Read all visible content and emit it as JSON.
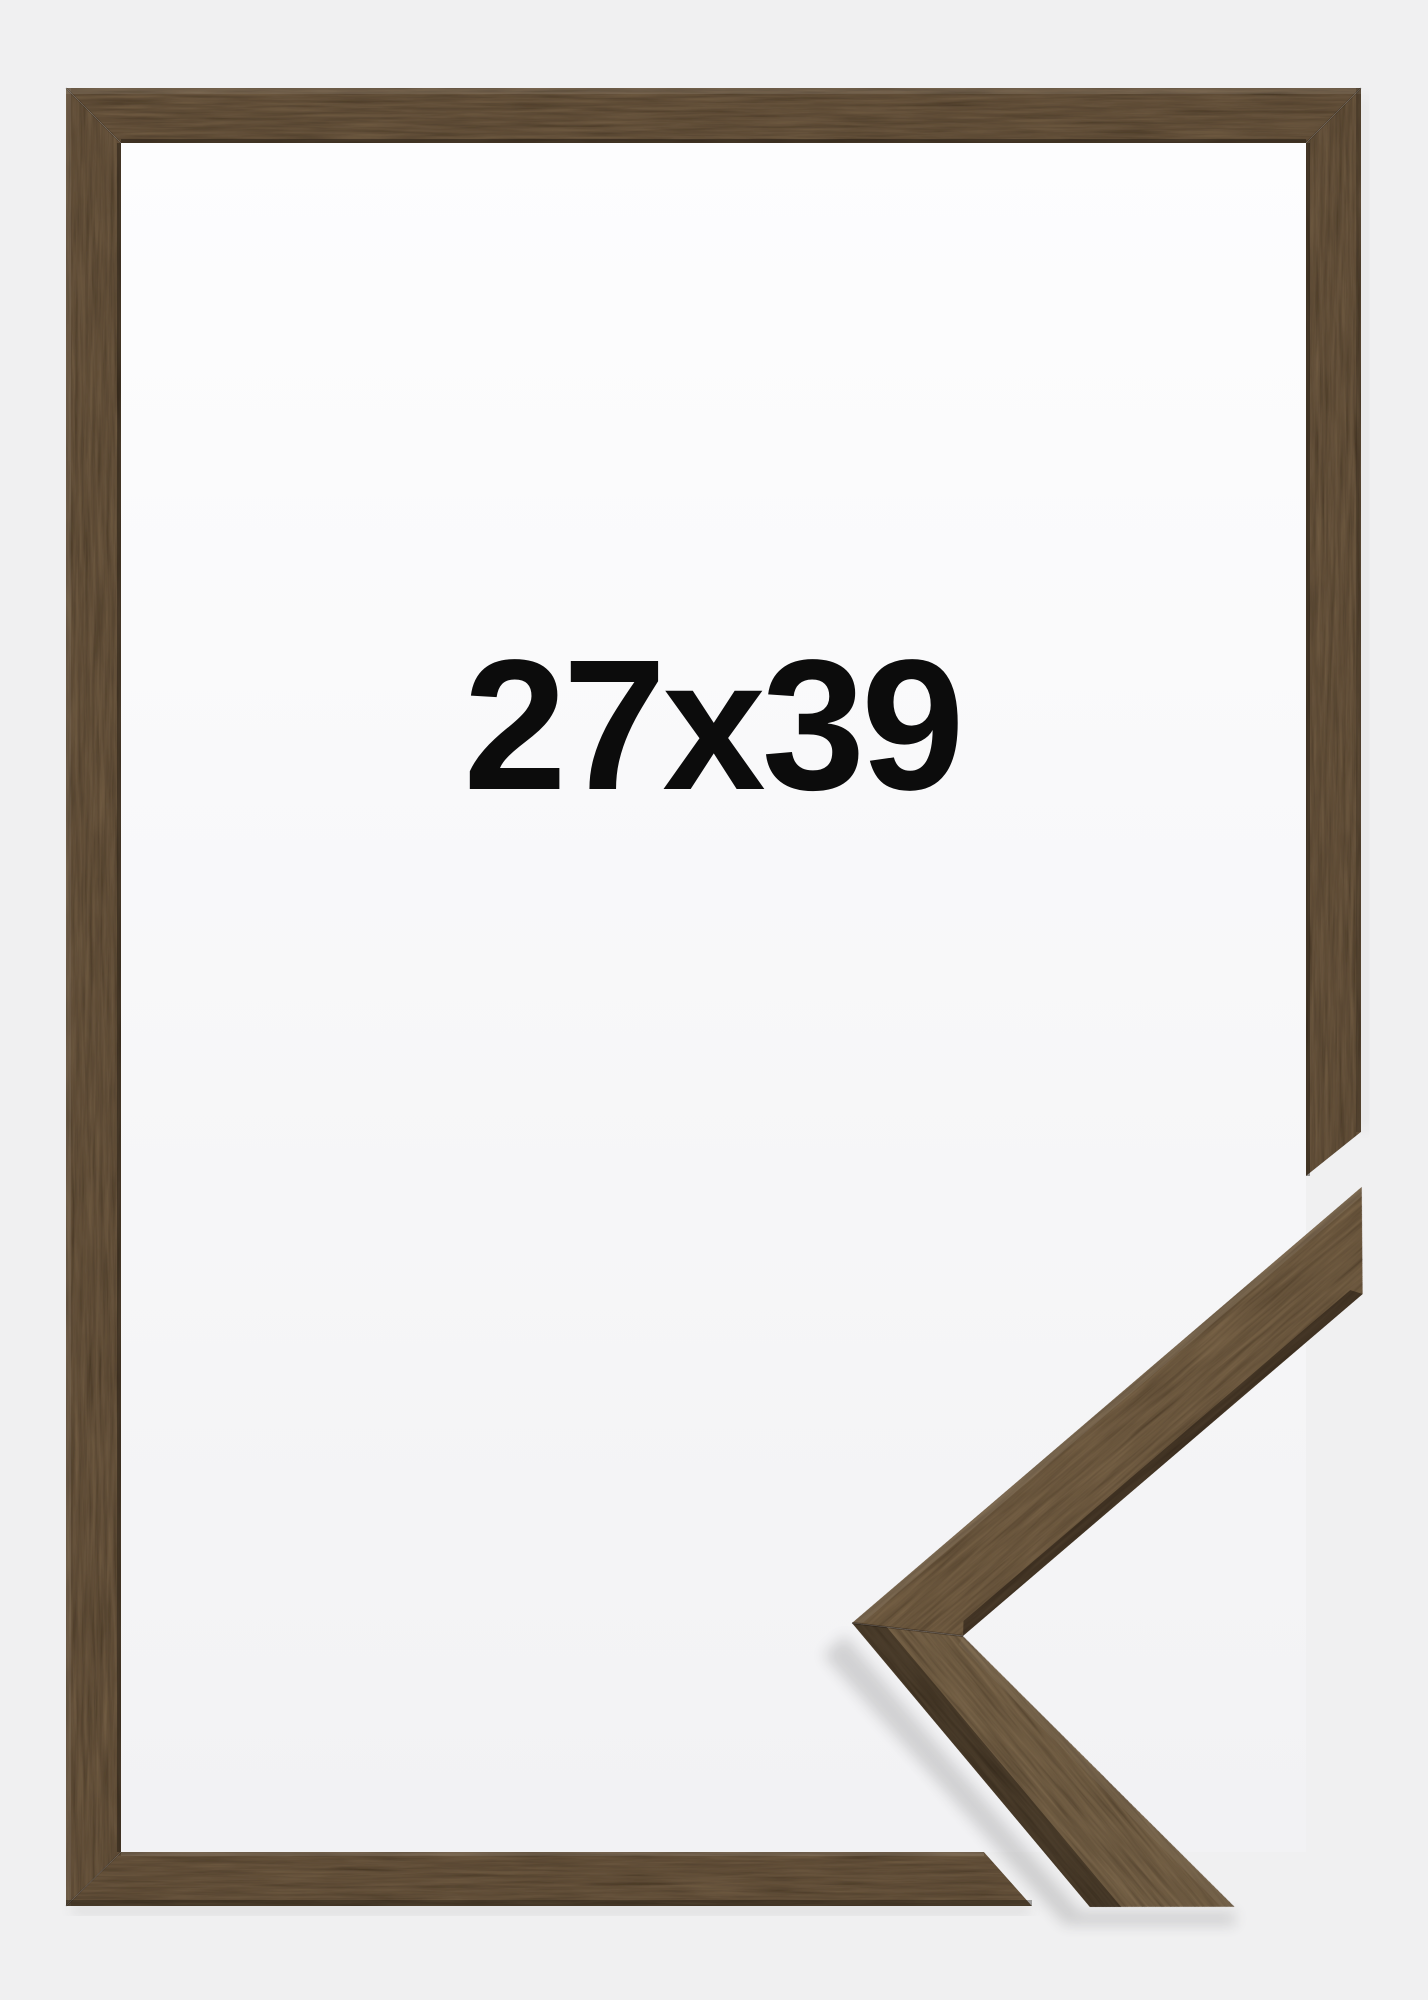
{
  "product": {
    "size_label": "27x39"
  },
  "palette": {
    "background": "#f0f0f1",
    "opening_top": "#fdfdfe",
    "opening_bottom": "#f2f2f4",
    "label_color": "#0c0c0c",
    "frame_wood": "#6f5c44",
    "sample_wood_upper": "#7a664b",
    "sample_wood_lower": "#7d6a4f"
  }
}
